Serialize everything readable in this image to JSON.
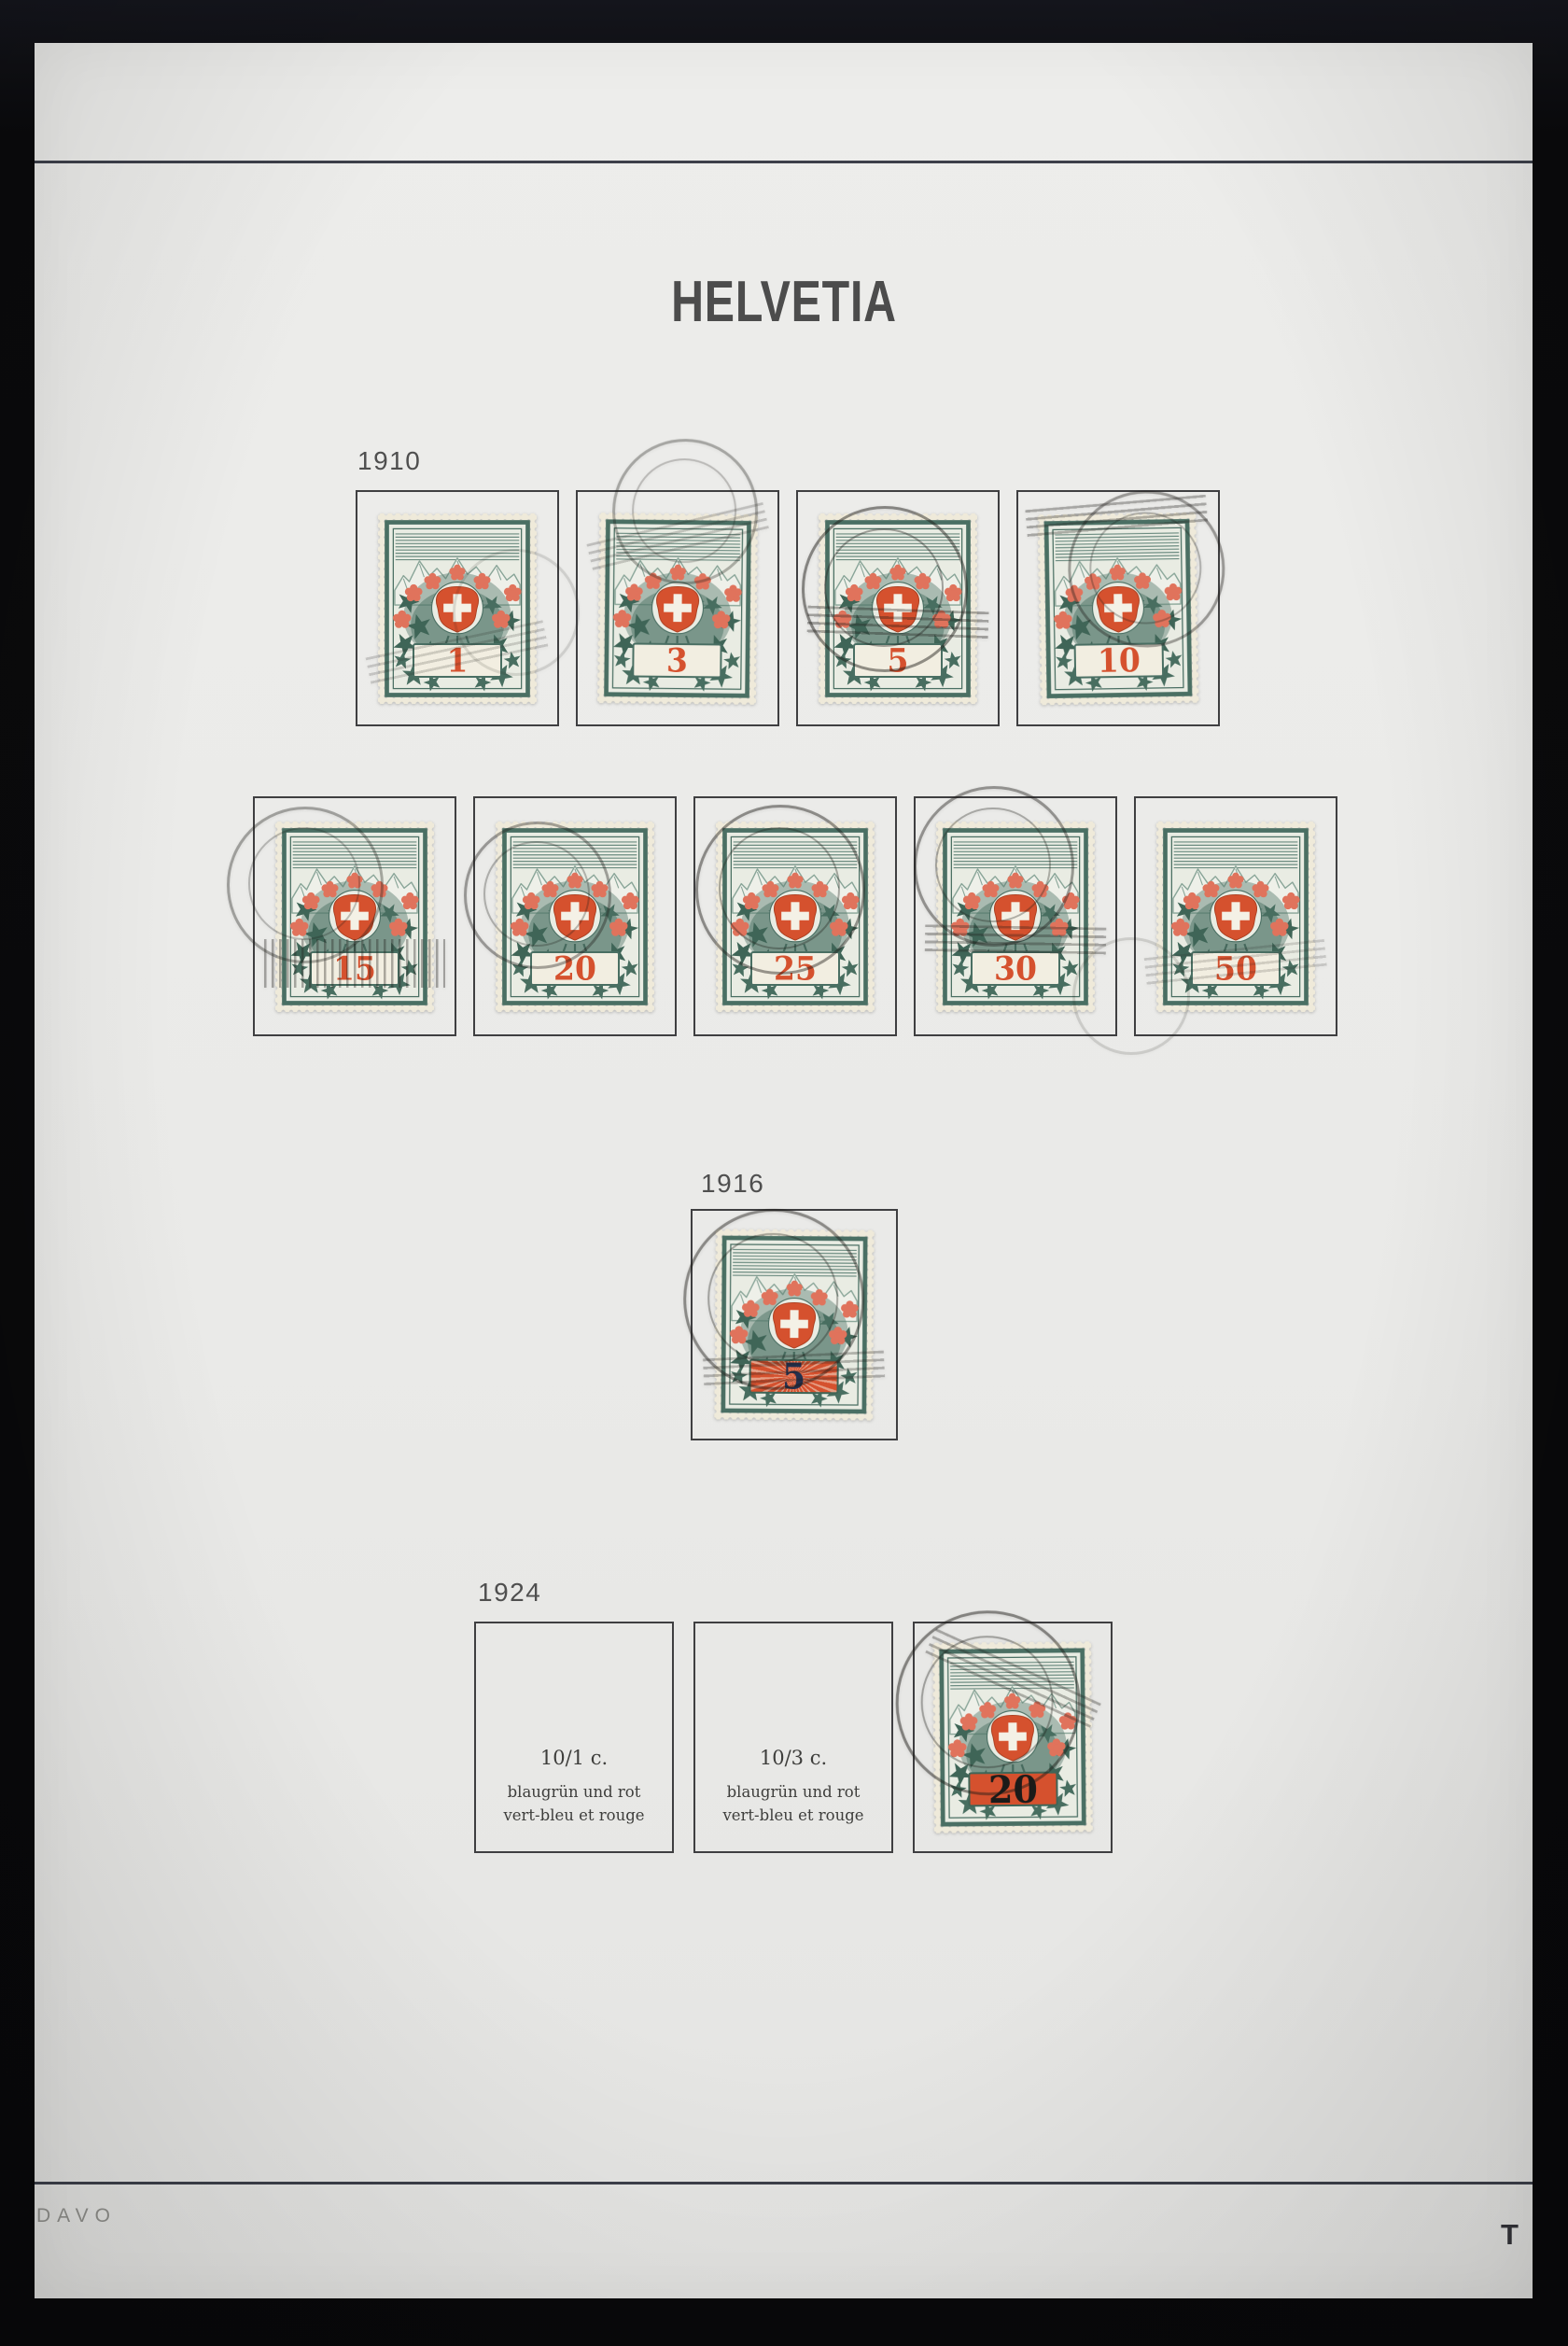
{
  "album_page": {
    "country_title": "HELVETIA",
    "publisher_mark": "DAVO",
    "page_letter": "T"
  },
  "colors": {
    "page-bg": "#eaeae8",
    "surround": "#0b0b0d",
    "rule": "#3d404a",
    "box-border": "#3f3f41",
    "ink": "#4c4c4c",
    "stamp-paper": "#efeada",
    "stamp-green": "#4a6f63",
    "stamp-red": "#d5512e",
    "flower": "#e0735c",
    "overprint-1916": "#23304e",
    "overprint-1924": "#1c1b19"
  },
  "sections": [
    {
      "year": "1910",
      "rows": [
        {
          "stamps": [
            {
              "value": "1"
            },
            {
              "value": "3"
            },
            {
              "value": "5"
            },
            {
              "value": "10"
            }
          ]
        },
        {
          "stamps": [
            {
              "value": "15"
            },
            {
              "value": "20"
            },
            {
              "value": "25"
            },
            {
              "value": "30"
            },
            {
              "value": "50"
            }
          ]
        }
      ]
    },
    {
      "year": "1916",
      "rows": [
        {
          "stamps": [
            {
              "value": "5"
            }
          ]
        }
      ]
    },
    {
      "year": "1924",
      "rows": [
        {
          "stamps": [
            {
              "caption_value": "10/1 c.",
              "caption_line2": "blaugrün und rot",
              "caption_line3": "vert-bleu et rouge"
            },
            {
              "caption_value": "10/3 c.",
              "caption_line2": "blaugrün und rot",
              "caption_line3": "vert-bleu et rouge"
            },
            {
              "value": "20"
            }
          ]
        }
      ]
    }
  ]
}
